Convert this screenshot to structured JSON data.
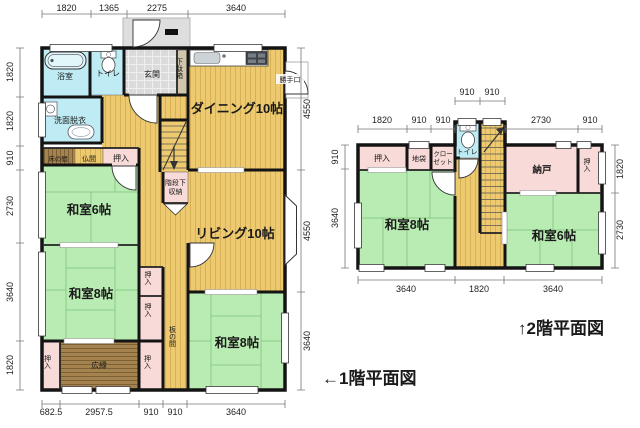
{
  "colors": {
    "tatami_green": "#b9ecb2",
    "flooring_tan": "#edc96f",
    "water_cyan": "#bfecf4",
    "closet_pink": "#f8dad8",
    "wood_brown": "#a5834f",
    "entrance_grey": "#dbdbdb",
    "wall_black": "#141414"
  },
  "floor1": {
    "caption": "←1階平面図",
    "dims": {
      "top": [
        "1820",
        "1365",
        "2275",
        "3640"
      ],
      "left": [
        "1820",
        "1820",
        "910",
        "2730",
        "3640",
        "1820"
      ],
      "right": [
        "4550",
        "4550",
        "3640"
      ],
      "bottom": [
        "682.5",
        "2957.5",
        "910",
        "910",
        "3640"
      ]
    },
    "rooms": {
      "bath": "浴室",
      "toilet": "トイレ",
      "entrance": "玄関",
      "shoe_cabinet": "下駄箱",
      "dining": "ダイニング10帖",
      "back_door": "勝手口",
      "washroom": "洗面脱衣",
      "alcove": "床の間",
      "altar_room": "仏間",
      "closet": "押入",
      "under_stairs_line1": "階段下",
      "under_stairs_line2": "収納",
      "washitsu6": "和室6帖",
      "living": "リビング10帖",
      "washitsu8": "和室8帖",
      "itanoma": "板の間",
      "veranda": "広縁"
    }
  },
  "floor2": {
    "caption": "↑2階平面図",
    "dims": {
      "top_upper": [
        "910",
        "910"
      ],
      "top": [
        "1820",
        "910",
        "910",
        "2730",
        "910"
      ],
      "left": [
        "910",
        "3640"
      ],
      "right": [
        "1820",
        "2730"
      ],
      "bottom": [
        "3640",
        "1820",
        "3640"
      ]
    },
    "rooms": {
      "closet": "押入",
      "jibukuro": "地袋",
      "wardrobe_line1": "クロー",
      "wardrobe_line2": "ゼット",
      "toilet": "トイレ",
      "storage": "納戸",
      "washitsu8": "和室8帖",
      "washitsu6": "和室6帖"
    }
  }
}
